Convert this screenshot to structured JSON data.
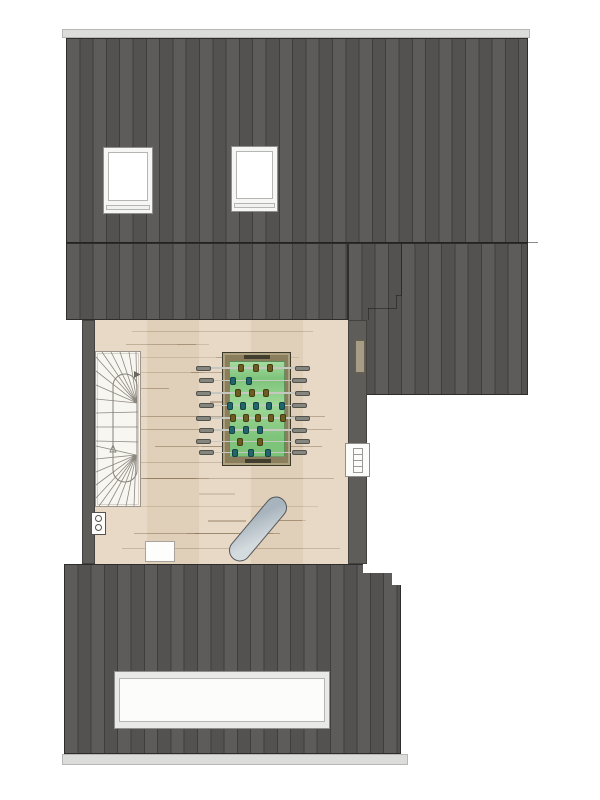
{
  "drawing_type": "attic-floor-plan",
  "visible_text": [],
  "palette": {
    "background": "#ffffff",
    "roof_base": "#585654",
    "roof_stripe": "#403e3c",
    "roof_outline": "#2e2d2b",
    "ridge_cap": "#dcdcda",
    "eave_strip": "#d8d8d6",
    "wall": "#5f5d5a",
    "floor_wood": "#e5d5c0",
    "plank_line": "#7d6448",
    "stair_fill": "#f8f6f1",
    "stair_line": "#8d887f",
    "frame_gray": "#8f8f8c",
    "pane_white": "#ffffff",
    "vent_tan": "#a79c85",
    "board_light": "#d4dbdf",
    "board_dark": "#a8b4bd",
    "board_outline": "#53565a"
  },
  "roof": {
    "top_skylight_count": 2,
    "bottom_skylight_count": 1,
    "stripe_period_px": 13.3
  },
  "icons": {
    "stair_walkline_arrow": "triangle-right",
    "stair_direction_marker": "triangle-up"
  },
  "foosball": {
    "frame": "#8a7e5d",
    "frame_outline": "#3d392c",
    "field": "#7dc37a",
    "field_sheen": "#9fd898",
    "rod": "#c7c7c1",
    "grip": "#86867e",
    "goal": "#423e2f",
    "teams": {
      "olive": "#6b5c20",
      "teal": "#20666a"
    },
    "rods": [
      {
        "y": 368,
        "team": "olive",
        "xs": [
          241,
          256,
          270
        ]
      },
      {
        "y": 380.5,
        "team": "teal",
        "xs": [
          233,
          249
        ]
      },
      {
        "y": 393,
        "team": "olive",
        "xs": [
          238,
          252,
          266
        ]
      },
      {
        "y": 405.5,
        "team": "teal",
        "xs": [
          230,
          243,
          256,
          269,
          282
        ]
      },
      {
        "y": 418,
        "team": "olive",
        "xs": [
          233,
          246,
          258,
          271,
          283
        ]
      },
      {
        "y": 430,
        "team": "teal",
        "xs": [
          232,
          246,
          260
        ]
      },
      {
        "y": 441.5,
        "team": "olive",
        "xs": [
          240,
          260
        ]
      },
      {
        "y": 452.5,
        "team": "teal",
        "xs": [
          235,
          251,
          268
        ]
      }
    ]
  }
}
